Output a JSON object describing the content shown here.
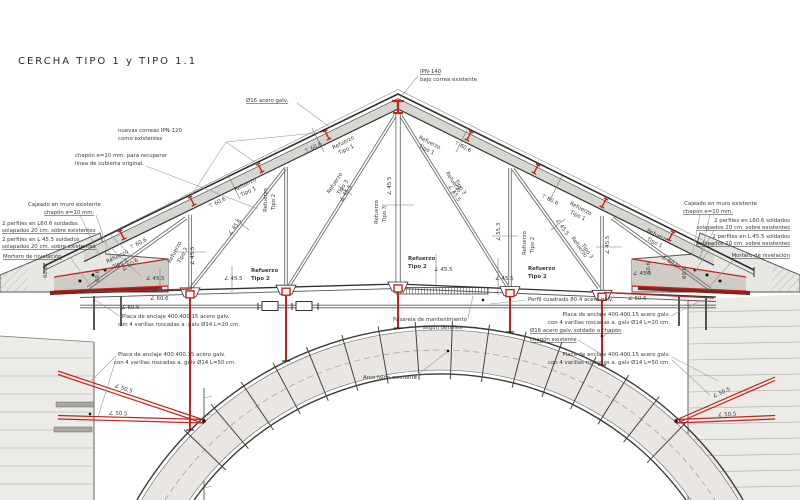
{
  "title": "CERCHA TIPO 1 y TIPO 1.1",
  "colors": {
    "accent_red": "#c1241d",
    "line": "#3b3b3b",
    "wall_fill": "#e9e7e3",
    "chord_fill": "#d8d6d1",
    "arch_fill": "#eae7e2",
    "mortar": "#7e241e"
  },
  "labels": {
    "ipn1": "IPN-140",
    "ipn2": "bajo correa existente",
    "o16": "Ø16 acero galv.",
    "correas1": "nuevas correas IPN-120",
    "correas2": "como existentes",
    "chapon1": "chapón e=10 mm. para recuperar",
    "chapon2": "línea de cubierta original.",
    "cajeado1": "Cajeado en muro existente",
    "cajeado2": "chapón e=10 mm.",
    "perf60a": "2 perfiles en L60.6 soldados",
    "perf60b": "solapados 20 cm. sobre existentes",
    "perf45a": "2 perfiles en L 45.5 soldados",
    "perf45b": "solapados 20 cm. sobre existentes",
    "mortero": "Mortero de nivelación",
    "placa": "Placa de anclaje 400.400.15 acero galv.",
    "varillas20": "con 4 varillas roscadas a. galv Ø14 L=20 cm.",
    "varillas50": "con 4 varillas roscadas a. galv Ø14 L=50 cm.",
    "perfil_cuadrado": "Perfil cuadrado 80.4 acero galv.",
    "pasarela1": "Pasarela de mantenimiento",
    "pasarela2": "según detalles",
    "arco": "Arco fajón existente",
    "o16_soldado": "Ø16 acero galv. soldado a chapón",
    "chapon_exist": "chapón existente",
    "refuerzo": "Refuerzo",
    "tipo1": "Tipo 1",
    "tipo2": "Tipo 2",
    "tipo3": "Tipo 3",
    "t606": "⊤ 60.6",
    "l455": "∠ 45.5",
    "l505": "∠ 50.5",
    "l606": "∠ 60.6",
    "l553": "∠ 55.3",
    "d606": "60.6"
  }
}
